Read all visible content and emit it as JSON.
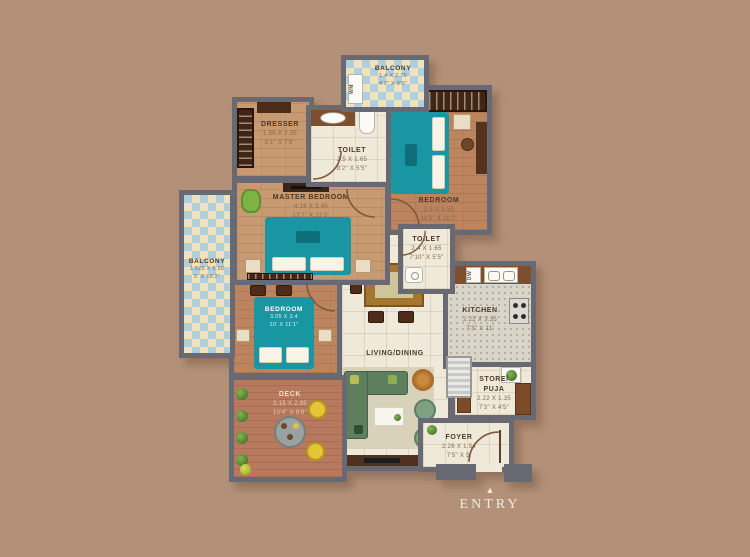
{
  "meta": {
    "type": "apartment-floor-plan"
  },
  "rooms": [
    {
      "name": "BALCONY",
      "dim_m": "1.4 X 2.75",
      "dim_ft": "4'7\" X 9'0\""
    },
    {
      "name": "DRESSER",
      "dim_m": "1.56 X 2.35",
      "dim_ft": "5'1\" X 7'8\""
    },
    {
      "name": "TOILET",
      "dim_m": "2.5 X 1.65",
      "dim_ft": "8'2\" X 5'5\""
    },
    {
      "name": "BEDROOM",
      "dim_m": "3.5 X 3.55",
      "dim_ft": "11'5\" X 11'7\""
    },
    {
      "name": "MASTER BEDROOM",
      "dim_m": "4.16 X 3.45",
      "dim_ft": "13'7\" X 11'3\""
    },
    {
      "name": "BALCONY",
      "dim_m": "1.525 X 5.56",
      "dim_ft": "5' X 18'2\""
    },
    {
      "name": "TOILET",
      "dim_m": "2.4 X 1.65",
      "dim_ft": "7'10\" X 5'5\""
    },
    {
      "name": "KITCHEN",
      "dim_m": "2.22 X 3.35",
      "dim_ft": "7'3\" X 11'"
    },
    {
      "name": "LIVING/DINING"
    },
    {
      "name": "BEDROOM",
      "dim_m": "3.05 X 3.4",
      "dim_ft": "10' X 11'1\""
    },
    {
      "name": "DECK",
      "dim_m": "3.15 X 2.95",
      "dim_ft": "10'4\" X 9'8\""
    },
    {
      "name": "STORE/ PUJA",
      "dim_m": "2.22 X 1.35",
      "dim_ft": "7'3\" X 4'5\""
    },
    {
      "name": "FOYER",
      "dim_m": "2.26 X 1.54",
      "dim_ft": "7'5\" X 5'"
    }
  ],
  "labels": {
    "wm": "WM",
    "dw": "DW"
  },
  "entry": {
    "arrow": "▲",
    "label": "ENTRY"
  },
  "colors": {
    "background": "#b39178",
    "wall": "#686973",
    "bed_teal": "#1897a3",
    "sofa_green": "#5d7f5e",
    "checker_blue": "#aecfdd",
    "checker_cream": "#f0e2bd",
    "wood_floor": "#bc855f",
    "tile_floor": "#efe9d9",
    "deck_floor": "#b87a5e",
    "chair_yellow": "#e5c435"
  }
}
